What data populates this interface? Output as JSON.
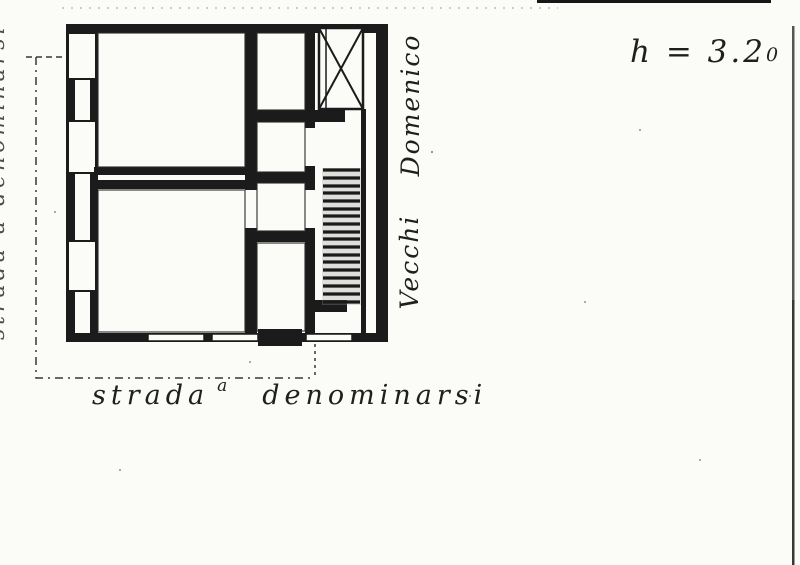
{
  "annotations": {
    "height_label": {
      "text": "h = 3.2",
      "suffix": "0"
    },
    "name_vertical_top": "Domenico",
    "name_vertical_bottom": "Vecchi",
    "street_label_bottom": {
      "word1": "strada",
      "superscript": "a",
      "word2": "denominarsi"
    },
    "street_label_left": "strada a denominarsi"
  },
  "drawing": {
    "features": [
      "outer-masonry-walls",
      "large-room-upper",
      "large-room-lower",
      "small-room-top",
      "small-room-middle",
      "corridor",
      "small-room-bottom",
      "staircase-with-treads",
      "crossed-shaft-box",
      "window-openings",
      "entrance-threshold",
      "dimension-line-left",
      "dimension-line-bottom"
    ]
  },
  "colors": {
    "paper": "#fbfbf8",
    "ink": "#1b1b1b",
    "faint_ink": "#383838",
    "scan_edge": "#4a4a4a"
  }
}
